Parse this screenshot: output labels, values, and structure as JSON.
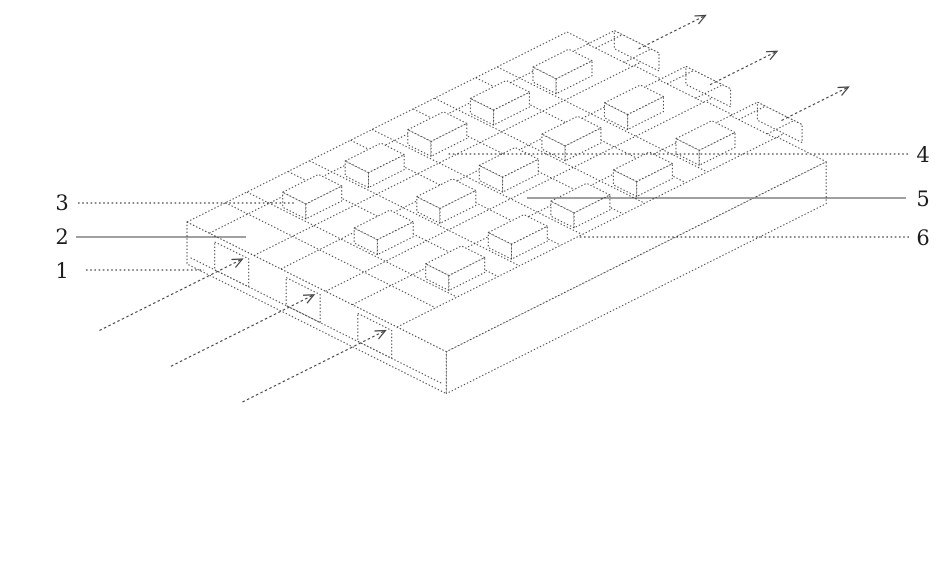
{
  "figure": {
    "kind": "patent-isometric-line-drawing",
    "background": "#ffffff",
    "line_color": "#414141",
    "label_color": "#1c1c1c"
  },
  "labels": [
    {
      "ref": "1",
      "side": "left",
      "leader_style": "dotted"
    },
    {
      "ref": "2",
      "side": "left",
      "leader_style": "solid"
    },
    {
      "ref": "3",
      "side": "left",
      "leader_style": "dotted"
    },
    {
      "ref": "4",
      "side": "right",
      "leader_style": "dotted"
    },
    {
      "ref": "5",
      "side": "right",
      "leader_style": "solid"
    },
    {
      "ref": "6",
      "side": "right",
      "leader_style": "dotted"
    }
  ],
  "flow_arrows": {
    "inlet_count": 3,
    "outlet_count": 3,
    "icon": "flow-direction-arrow"
  }
}
